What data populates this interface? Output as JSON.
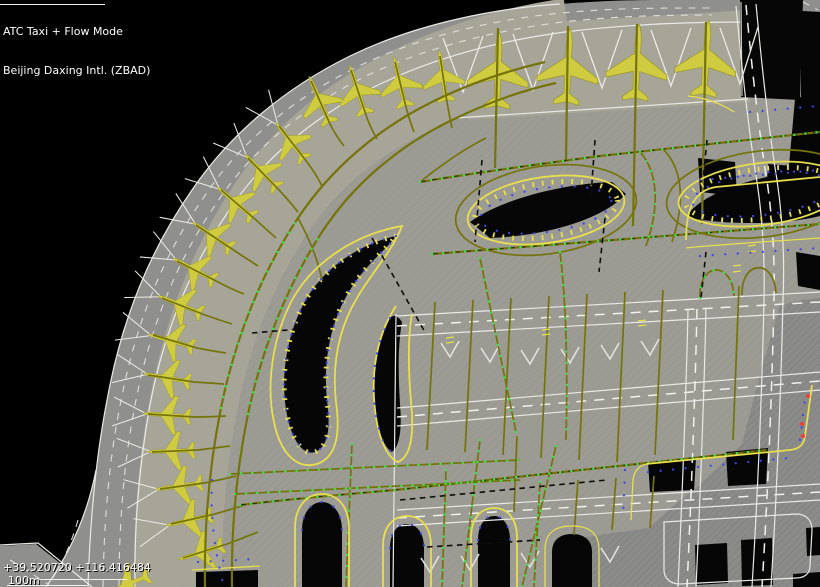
{
  "hud": {
    "mode_line": "ATC Taxi + Flow Mode",
    "airport_line": "Beijing Daxing Intl. (ZBAD)"
  },
  "statusbar": {
    "coordinates": "+39.520720 +116.416484",
    "scale_label": "100m"
  },
  "map": {
    "airport_name": "Beijing Daxing Intl.",
    "airport_icao": "ZBAD",
    "colors": {
      "background": "#000000",
      "pavement": "#9c9b94",
      "stand_apron": "#a7a598",
      "perimeter_road": "#8f8f8d",
      "landside_area": "#8b8b89",
      "taxi_line": "#75740b",
      "apron_edge_line": "#e7df4e",
      "centerline_lights": "#42df4f",
      "edge_lights": "#3d47e6",
      "stop_lights": "#ee3d3d",
      "aircraft": "#d0cc42",
      "road_markings": "#e9e9e6"
    },
    "aircraft_counts": {
      "top_row_heavies": 4,
      "upper_arc_jets": 4,
      "left_arc_jets": 13,
      "partial_bottom_left": 1
    }
  }
}
